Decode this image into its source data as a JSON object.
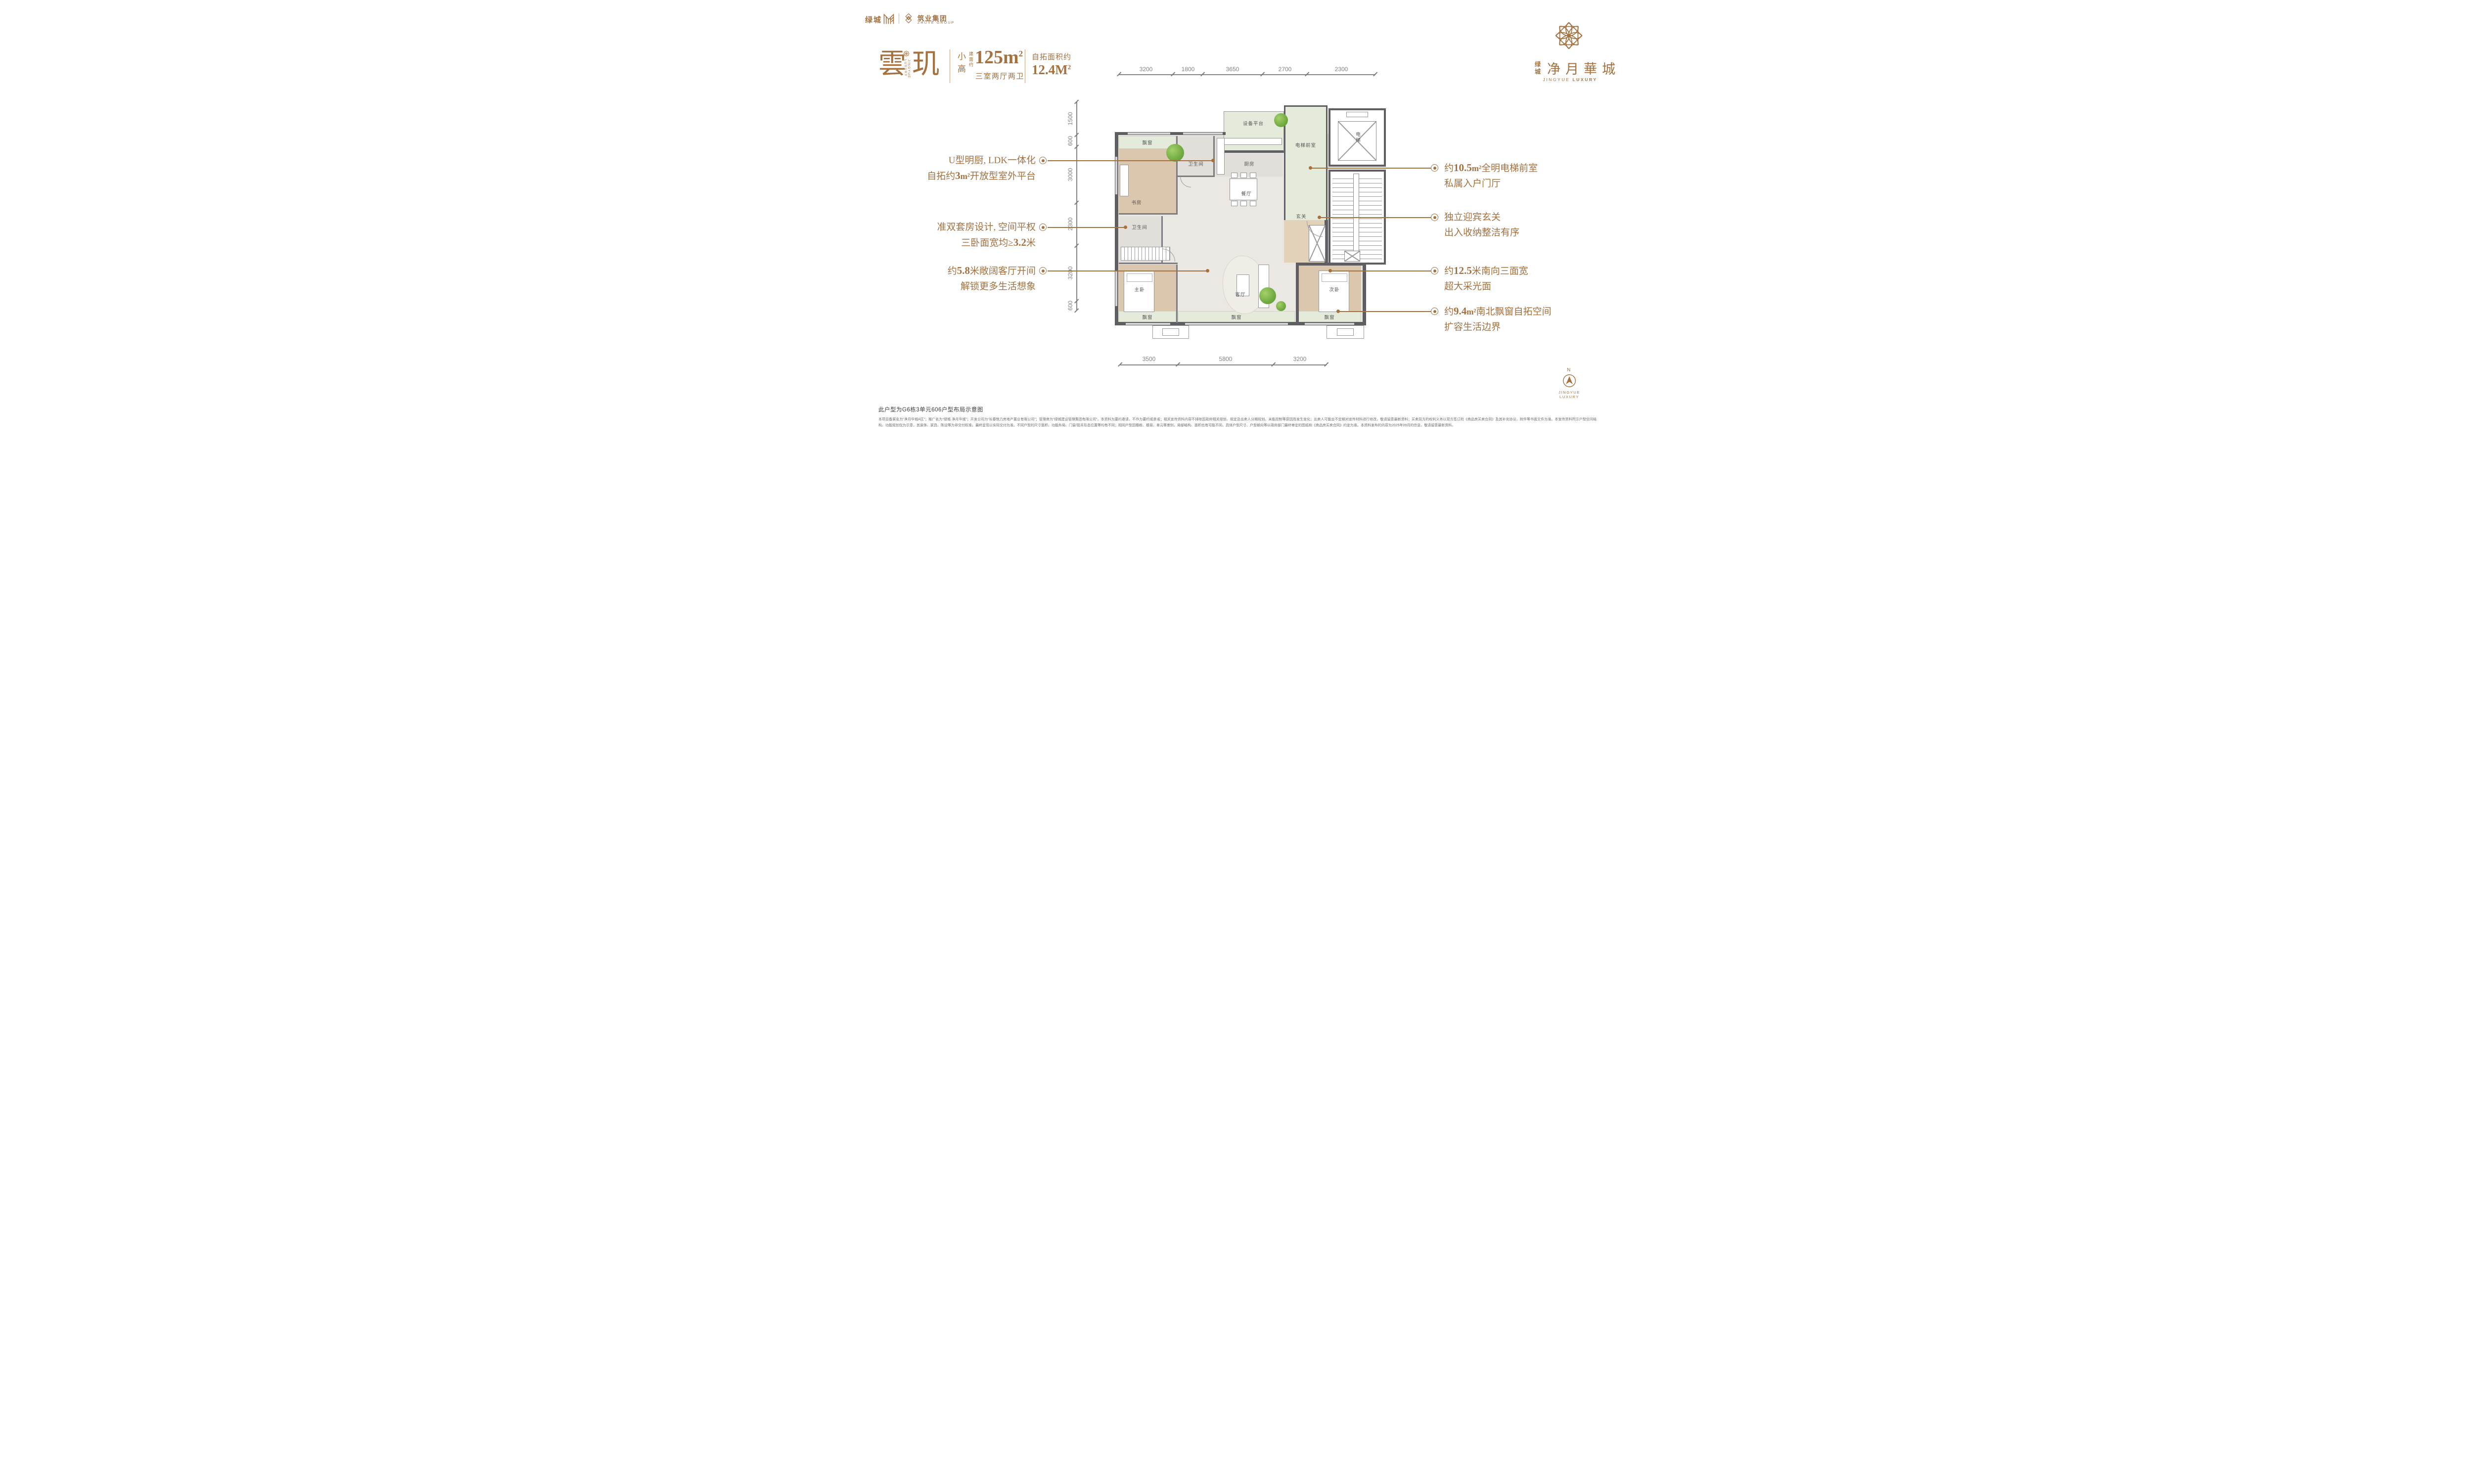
{
  "colors": {
    "accent": "#a5713f",
    "wall": "#5f5f63",
    "plan_green": "#e4ebda",
    "plan_wood": "#dbc7ae"
  },
  "header": {
    "left": {
      "greentown": "绿城",
      "group": "筑业集团",
      "group_en": "ZHUYE GROUP"
    },
    "right": {
      "small": "绿城",
      "name": "净月華城",
      "en_regular": "JINGYUE",
      "en_bold": "LUXURY"
    }
  },
  "title": {
    "char1": "雲",
    "char2": "玑",
    "vertical_en": "JINGYUE LUXURY",
    "class": "小高",
    "area_prefix": "建面约",
    "area": "125m",
    "area_sup": "2",
    "rooms": "三室两厅两卫",
    "expand_label": "自拓面积约",
    "expand": "12.4M",
    "expand_sup": "2"
  },
  "plan": {
    "rooms": {
      "bay_tl": "飘窗",
      "study": "书房",
      "bath1": "卫生间",
      "kitchen": "厨房",
      "equipment": "设备平台",
      "lobby": "电梯前室",
      "elevator": "电梯",
      "dining": "餐厅",
      "foyer": "玄关",
      "bath2": "卫生间",
      "master": "主卧",
      "living": "客厅",
      "second": "次卧",
      "bay_b1": "飘窗",
      "bay_b2": "飘窗",
      "bay_b3": "飘窗"
    },
    "dims": {
      "top": [
        "3200",
        "1800",
        "3650",
        "2700",
        "2300"
      ],
      "left": [
        "1500",
        "600",
        "3000",
        "2300",
        "3200",
        "600"
      ],
      "bottom": [
        "3500",
        "5800",
        "3200"
      ]
    }
  },
  "ann": {
    "left": [
      {
        "line1": "U型明厨, LDK一体化",
        "line2_pre": "自拓约",
        "line2_num": "3",
        "line2_unit": "m²",
        "line2_post": "开放型室外平台"
      },
      {
        "line1": "准双套房设计, 空间平权",
        "line2_pre": "三卧面宽均≥",
        "line2_num": "3.2",
        "line2_post": "米"
      },
      {
        "line1_pre": "约",
        "line1_num": "5.8",
        "line1_post": "米敞阔客厅开间",
        "line2": "解锁更多生活想象"
      }
    ],
    "right": [
      {
        "line1_pre": "约",
        "line1_num": "10.5",
        "line1_unit": "m²",
        "line1_post": "全明电梯前室",
        "line2": "私属入户门厅"
      },
      {
        "line1": "独立迎宾玄关",
        "line2": "出入收纳整洁有序"
      },
      {
        "line1_pre": "约",
        "line1_num": "12.5",
        "line1_post": "米南向三面宽",
        "line2": "超大采光面"
      },
      {
        "line1_pre": "约",
        "line1_num": "9.4",
        "line1_unit": "m²",
        "line1_post": "南北飘窗自拓空间",
        "line2": "扩容生活边界"
      }
    ]
  },
  "footer": {
    "note": "此户型为G6栋3单元606户型布局示意图",
    "disclaimer": "本项目备案名为“净月华城A区”；推广名为“绿城·净月华城”；开发公司为“长春筑力房地产置业有限公司”；管理商为“绿城建设管理集团有限公司”。本资料为要约邀请，不作为要约或承诺；相关宣传资料内容不排除因政府相关规划、规定及出卖人分期规划、未能控制等原因而发生变化；出卖人可能会不定期对宣传材料进行修改，敬请留意最新资料；买卖双方的权利义务以双方签订的《商品房买卖合同》及其补充协议、附件等书面文件为准。本宣传资料所示户型空间结构、功能规划仅为示意，其装饰、家具、陈设等为非交付标准，最终呈现以实际交付为准。不同户型的尺寸面积、功能布局、门窗/管井形态位置等均有不同；相同户型因楼栋、楼层、单元等差别，局部结构、面积也有可能不同，具体户型尺寸、户型朝向等以政府部门最终审定的图纸和《商品房买卖合同》约定为准。本资料发布的内容为2025年09月的信息，敬请留意最新资料。",
    "compass_n": "N",
    "compass_brand": "JINGYUE LUXURY"
  }
}
